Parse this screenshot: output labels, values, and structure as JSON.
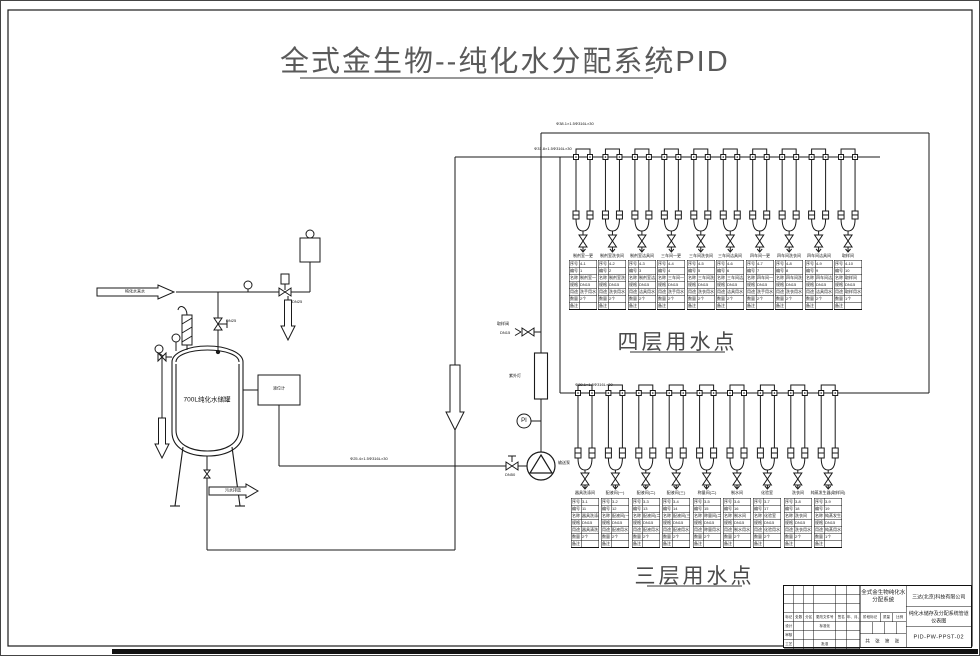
{
  "title": {
    "text": "全式金生物--纯化水分配系统PID"
  },
  "sections": {
    "fourth": "四层用水点",
    "third": "三层用水点"
  },
  "tank": {
    "label": "700L纯化水储罐",
    "inlet_arrow": "纯化水来水",
    "drain_arrow": "污水排放",
    "level_box": "液位计"
  },
  "equipment": {
    "pump": "输送泵",
    "uv": "紫外灯",
    "pi": "PI",
    "sample_valve": "取样阀",
    "sample_valve_size": "DN15",
    "inlet_valve_size": "DN25",
    "regulator_size": "DN25",
    "suction_valve_size": "DN50"
  },
  "pipes": {
    "supply_header": "Φ38.1×1.5Φ316L×30",
    "return_header": "Φ31.8×1.5Φ316L×30",
    "third_header": "Φ38.1×1.5Φ316L×30",
    "suction": "Φ25.4×1.5Φ316L×30"
  },
  "table_fields": [
    "序号",
    "编号",
    "名称",
    "规格",
    "用途",
    "数量",
    "备注"
  ],
  "fourth_floor": {
    "points": [
      {
        "label": "制剂室一更",
        "table": {
          "no": "4-1",
          "id": "1",
          "name": "制剂室一更",
          "spec": "DN15",
          "use": "洗手用水",
          "qty": "2个",
          "note": ""
        }
      },
      {
        "label": "制剂室洗衣间",
        "table": {
          "no": "4-2",
          "id": "2",
          "name": "制剂室洗衣间",
          "spec": "DN15",
          "use": "洗衣用水",
          "qty": "2个",
          "note": ""
        }
      },
      {
        "label": "制剂室洁具间",
        "table": {
          "no": "4-3",
          "id": "3",
          "name": "制剂室洁具间",
          "spec": "DN15",
          "use": "洁具用水",
          "qty": "2个",
          "note": ""
        }
      },
      {
        "label": "三车间一更",
        "table": {
          "no": "4-4",
          "id": "4",
          "name": "三车间一更",
          "spec": "DN15",
          "use": "洗手用水",
          "qty": "2个",
          "note": ""
        }
      },
      {
        "label": "三车间洗衣间",
        "table": {
          "no": "4-5",
          "id": "5",
          "name": "三车间洗衣间",
          "spec": "DN15",
          "use": "洗衣用水",
          "qty": "2个",
          "note": ""
        }
      },
      {
        "label": "三车间洁具间",
        "table": {
          "no": "4-6",
          "id": "6",
          "name": "三车间洁具间",
          "spec": "DN15",
          "use": "洁具用水",
          "qty": "2个",
          "note": ""
        }
      },
      {
        "label": "四车间一更",
        "table": {
          "no": "4-7",
          "id": "7",
          "name": "四车间一更",
          "spec": "DN15",
          "use": "洗手用水",
          "qty": "2个",
          "note": ""
        }
      },
      {
        "label": "四车间洗衣间",
        "table": {
          "no": "4-8",
          "id": "8",
          "name": "四车间洗衣间",
          "spec": "DN15",
          "use": "洗衣用水",
          "qty": "2个",
          "note": ""
        }
      },
      {
        "label": "四车间洁具间",
        "table": {
          "no": "4-9",
          "id": "9",
          "name": "四车间洁具间",
          "spec": "DN15",
          "use": "洁具用水",
          "qty": "2个",
          "note": ""
        }
      },
      {
        "label": "取样间",
        "table": {
          "no": "4-10",
          "id": "10",
          "name": "取样间",
          "spec": "DN15",
          "use": "取样用水",
          "qty": "1个",
          "note": ""
        }
      }
    ]
  },
  "third_floor": {
    "points": [
      {
        "label": "器具洗涤间",
        "table": {
          "no": "3-1",
          "id": "11",
          "name": "器具洗涤间",
          "spec": "DN15",
          "use": "器具清洗",
          "qty": "2个",
          "note": ""
        }
      },
      {
        "label": "配液间(一)",
        "table": {
          "no": "3-2",
          "id": "12",
          "name": "配液间(一)",
          "spec": "DN15",
          "use": "配液用水",
          "qty": "2个",
          "note": ""
        }
      },
      {
        "label": "配液间(二)",
        "table": {
          "no": "3-3",
          "id": "13",
          "name": "配液间(二)",
          "spec": "DN15",
          "use": "配液用水",
          "qty": "2个",
          "note": ""
        }
      },
      {
        "label": "配液间(三)",
        "table": {
          "no": "3-4",
          "id": "14",
          "name": "配液间(三)",
          "spec": "DN15",
          "use": "配液用水",
          "qty": "2个",
          "note": ""
        }
      },
      {
        "label": "称量间(二)",
        "table": {
          "no": "3-5",
          "id": "15",
          "name": "称量间(二)",
          "spec": "DN15",
          "use": "称量用水",
          "qty": "2个",
          "note": ""
        }
      },
      {
        "label": "制水间",
        "table": {
          "no": "3-6",
          "id": "16",
          "name": "制水间",
          "spec": "DN15",
          "use": "制水用水",
          "qty": "2个",
          "note": ""
        }
      },
      {
        "label": "化验室",
        "table": {
          "no": "3-7",
          "id": "17",
          "name": "化验室",
          "spec": "DN15",
          "use": "化验用水",
          "qty": "2个",
          "note": ""
        }
      },
      {
        "label": "洗衣间",
        "table": {
          "no": "3-8",
          "id": "18",
          "name": "洗衣间",
          "spec": "DN15",
          "use": "洗衣用水",
          "qty": "2个",
          "note": ""
        }
      },
      {
        "label": "纯蒸发生器(取样间)",
        "table": {
          "no": "3-9",
          "id": "19",
          "name": "纯蒸发生器",
          "spec": "DN15",
          "use": "纯蒸用水",
          "qty": "1个",
          "note": ""
        }
      }
    ]
  },
  "titleblock": {
    "company": "三达(北京)科技有限公司",
    "project": "全式金生物纯化水分配系统",
    "dwg_title": "纯化水储存及分配系统管道仪表图",
    "dwg_no": "PID-PW-PPST-02",
    "stage_labels": [
      "阶段标记",
      "质量",
      "比例"
    ],
    "sheet": "共 张 第 张",
    "grid": [
      [
        "",
        "",
        "",
        "",
        "",
        ""
      ],
      [
        "",
        "",
        "",
        "",
        "",
        ""
      ],
      [
        "",
        "",
        "",
        "",
        "",
        ""
      ],
      [
        "标记",
        "处数",
        "分区",
        "更改文件号",
        "签名",
        "年、月、日"
      ],
      [
        "设计",
        "",
        "",
        "标准化",
        "",
        ""
      ],
      [
        "审核",
        "",
        "",
        "",
        "",
        ""
      ],
      [
        "工艺",
        "",
        "",
        "批准",
        "",
        ""
      ]
    ]
  }
}
